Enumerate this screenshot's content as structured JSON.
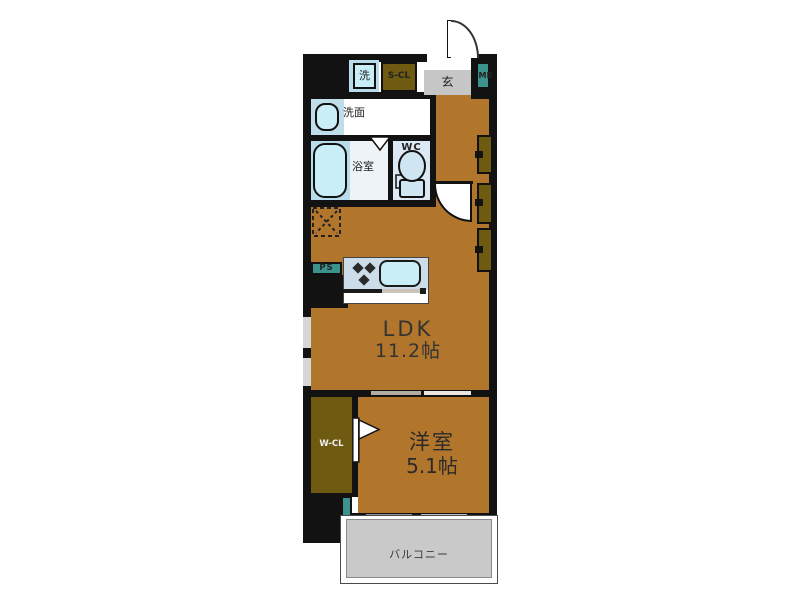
{
  "rooms": {
    "ldk": {
      "name": "LDK",
      "size": "11.2帖"
    },
    "western_room": {
      "name": "洋室",
      "size": "5.1帖"
    },
    "balcony": {
      "name": "バルコニー"
    },
    "washroom": {
      "name": "洗面"
    },
    "bathroom": {
      "name": "浴室"
    },
    "toilet": {
      "name": "WC"
    },
    "entrance": {
      "name": "玄"
    }
  },
  "fixtures": {
    "washer": {
      "name": "洗"
    },
    "storage_closet": {
      "name": "S-CL"
    },
    "meter_box": {
      "name": "MB"
    },
    "pipe_space": {
      "name": "PS"
    },
    "walk_in_closet": {
      "name": "W-CL"
    }
  },
  "colors": {
    "floor": "#b1762c",
    "dark_wood": "#6e5a11",
    "wall": "#121212",
    "teal": "#3c938d",
    "entrance_gray": "#c6c6c6",
    "balcony_gray": "#c9c9c9",
    "fixture_cyan": "#c9eef8",
    "fixture_pale_blue": "#b9dcea",
    "kitchen_counter": "#ccdde9",
    "wc_room": "#dce9f4",
    "bathroom_floor": "#edf3f6"
  }
}
